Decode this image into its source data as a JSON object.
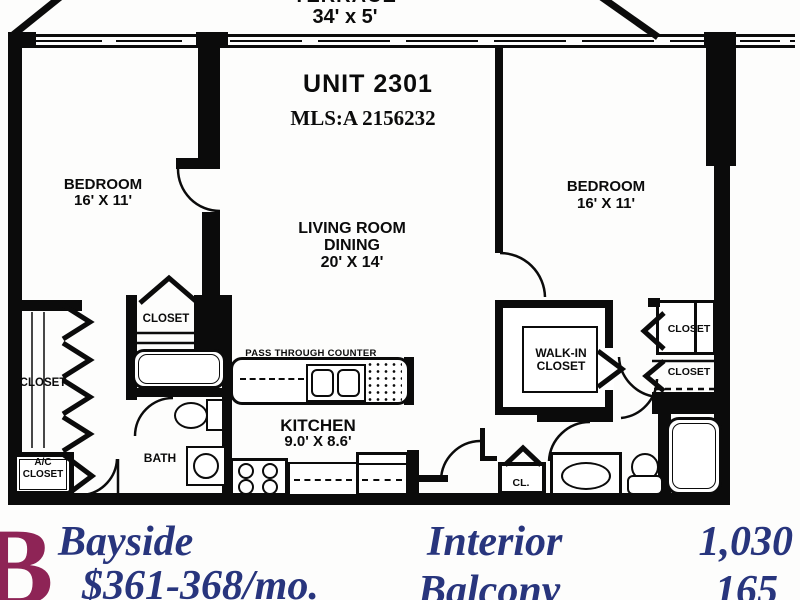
{
  "plan": {
    "unit_title": "UNIT 2301",
    "mls": "MLS:A 2156232",
    "terrace": {
      "name": "TERRACE",
      "dims": "34' x 5'"
    },
    "rooms": {
      "bedroom_left": {
        "name": "BEDROOM",
        "dims": "16' X 11'"
      },
      "bedroom_right": {
        "name": "BEDROOM",
        "dims": "16' X 11'"
      },
      "living": {
        "line1": "LIVING ROOM",
        "line2": "DINING",
        "dims": "20' X 14'"
      },
      "kitchen": {
        "name": "KITCHEN",
        "dims": "9.0' X 8.6'"
      },
      "bath": {
        "name": "BATH"
      },
      "pass_through": "PASS THROUGH COUNTER"
    },
    "closets": {
      "left": "CLOSET",
      "ac_line1": "A/C",
      "ac_line2": "CLOSET",
      "bath_closet": "CLOSET",
      "walkin_line1": "WALK-IN",
      "walkin_line2": "CLOSET",
      "right_top": "CLOSET",
      "right_bottom": "CLOSET",
      "hall": "CL."
    },
    "line_color": "#0b0b0b"
  },
  "footer": {
    "plan_letter": "B",
    "building_name": "Bayside",
    "price": "$361-368/mo.",
    "areas": [
      {
        "label": "Interior",
        "value": "1,030"
      },
      {
        "label": "Balcony",
        "value": "165"
      }
    ],
    "letter_color": "#8e2456",
    "text_color": "#28357d"
  }
}
